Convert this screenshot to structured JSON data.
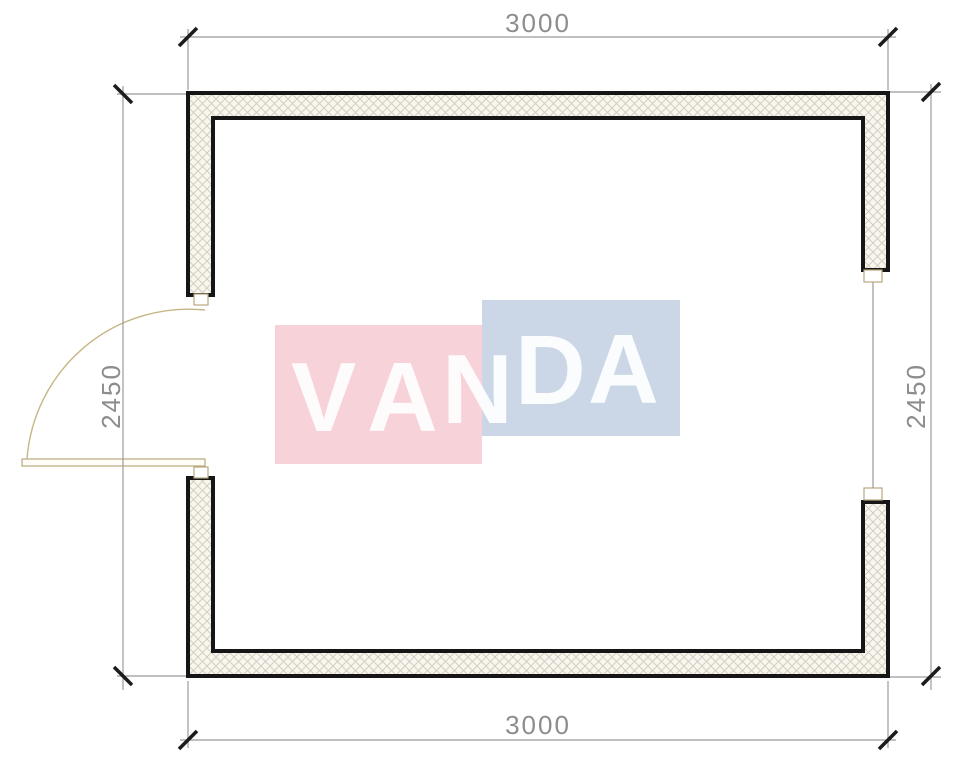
{
  "drawing": {
    "kind": "floor-plan",
    "dimensions": {
      "top_label": "3000",
      "bottom_label": "3000",
      "left_label": "2450",
      "right_label": "2450"
    },
    "watermark": {
      "brand": "VANDA",
      "letters": [
        "V",
        "A",
        "N",
        "D",
        "A"
      ],
      "pink_block_color": "#f8d2d9",
      "blue_block_color": "#cbd7e7",
      "letter_color": "#ffffff"
    },
    "colors": {
      "wall_outline": "#161616",
      "wall_hatch_line": "#d6cebd",
      "wall_hatch_background": "#f8f6f0",
      "dimension_line": "#9b9b9b",
      "dimension_text": "#8d8d8d",
      "tick_mark": "#1c1c1c",
      "door_swing": "#c8b586",
      "door_jamb": "#b7a87e"
    }
  }
}
